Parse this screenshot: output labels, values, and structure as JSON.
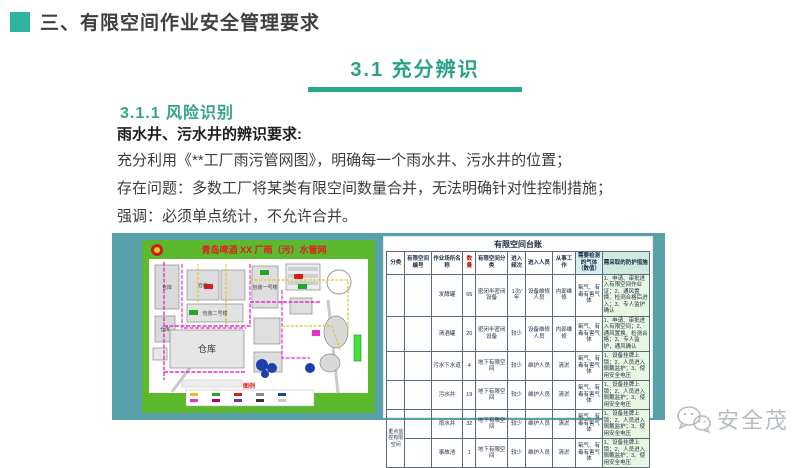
{
  "header": {
    "title": "三、有限空间作业安全管理要求"
  },
  "section": {
    "label": "3.1  充分辨识"
  },
  "content": {
    "subsection": "3.1.1  风险识别",
    "lead": "雨水井、污水井的辨识要求:",
    "line1": "充分利用《**工厂雨污管网图》，明确每一个雨水井、污水井的位置；",
    "line2": "存在问题：多数工厂将某类有限空间数量合并，无法明确针对性控制措施；",
    "line3": "强调：必须单点统计，不允许合并。"
  },
  "map": {
    "title": "青岛啤酒 XX 厂雨（污）水管网",
    "building_label_1": "仓库",
    "building_label_2": "仓库",
    "building_label_3": "仓库",
    "building_label_4": "包装二号楼",
    "building_label_5": "包装一号楼",
    "building_label_big": "仓库",
    "legend_label": "图例"
  },
  "ledger": {
    "title": "有限空间台账",
    "columns": [
      "分类",
      "有限空间编号",
      "作业场所名称",
      "数量",
      "有限空间分类",
      "进入频次",
      "进入人员",
      "从事工作",
      "需要检测的气体（数值）",
      "需采取的防护措施"
    ],
    "group_label": "重点监控有限空间",
    "rows": [
      {
        "code": "",
        "name": "发酵罐",
        "qty": "65",
        "type": "密闭半密闭设备",
        "freq": "1次/年",
        "people": "设备维修人员",
        "work": "内部维修",
        "gas": "氧气、有毒有害气体",
        "measures": "1、申请、审批进入有限空间作业证；2、通风置换、检测合格后进入；3、专人监护确认"
      },
      {
        "code": "",
        "name": "清酒罐",
        "qty": "20",
        "type": "密闭半密闭设备",
        "freq": "较少",
        "people": "设备维修人员",
        "work": "内部维修",
        "gas": "氧气、有毒有害气体",
        "measures": "1、申请、审批进入有限空间；2、通风置换、检测合格；3、专人监护，通风确认"
      },
      {
        "code": "",
        "name": "污水下水道",
        "qty": "4",
        "type": "地下有限空间",
        "freq": "较少",
        "people": "维护人员",
        "work": "清淤",
        "gas": "氧气、有毒有害气体",
        "measures": "1、设备挂牌上锁；2、人员进入佩戴监护；3、使用安全电压"
      },
      {
        "code": "",
        "name": "污水井",
        "qty": "19",
        "type": "地下有限空间",
        "freq": "较少",
        "people": "维护人员",
        "work": "清淤",
        "gas": "氧气、有毒有害气体",
        "measures": "1、设备挂牌上锁；2、人员进入佩戴监护；3、使用安全电压"
      },
      {
        "code": "",
        "name": "雨水井",
        "qty": "32",
        "type": "地下有限空间",
        "freq": "较少",
        "people": "维护人员",
        "work": "清淤",
        "gas": "氧气、有毒有害气体",
        "measures": "1、设备挂牌上锁；2、人员进入佩戴监护；3、使用安全电压"
      },
      {
        "code": "",
        "name": "事故池",
        "qty": "1",
        "type": "地下有限空间",
        "freq": "较少",
        "people": "维护人员",
        "work": "清淤",
        "gas": "氧气、有毒有害气体",
        "measures": "1、设备挂牌上锁；2、人员进入佩戴监护；3、使用安全电压"
      }
    ]
  },
  "watermark": {
    "label": "安全茂"
  }
}
